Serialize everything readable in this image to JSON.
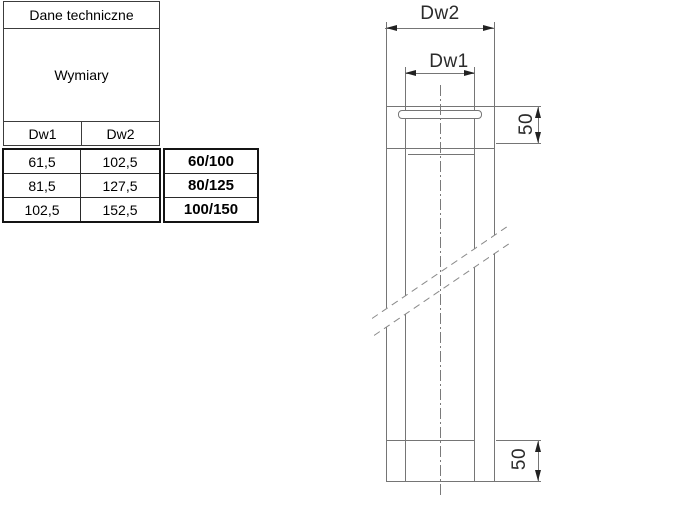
{
  "table": {
    "title": "Dane techniczne",
    "subtitle": "Wymiary",
    "columns": [
      "Dw1",
      "Dw2"
    ],
    "rows": [
      {
        "dw1": "61,5",
        "dw2": "102,5",
        "size": "60/100"
      },
      {
        "dw1": "81,5",
        "dw2": "127,5",
        "size": "80/125"
      },
      {
        "dw1": "102,5",
        "dw2": "152,5",
        "size": "100/150"
      }
    ]
  },
  "drawing": {
    "dim_outer_label": "Dw2",
    "dim_inner_label": "Dw1",
    "dim_top_label": "50",
    "dim_bottom_label": "50",
    "line_color": "#757575",
    "text_color": "#2b2b2b"
  }
}
